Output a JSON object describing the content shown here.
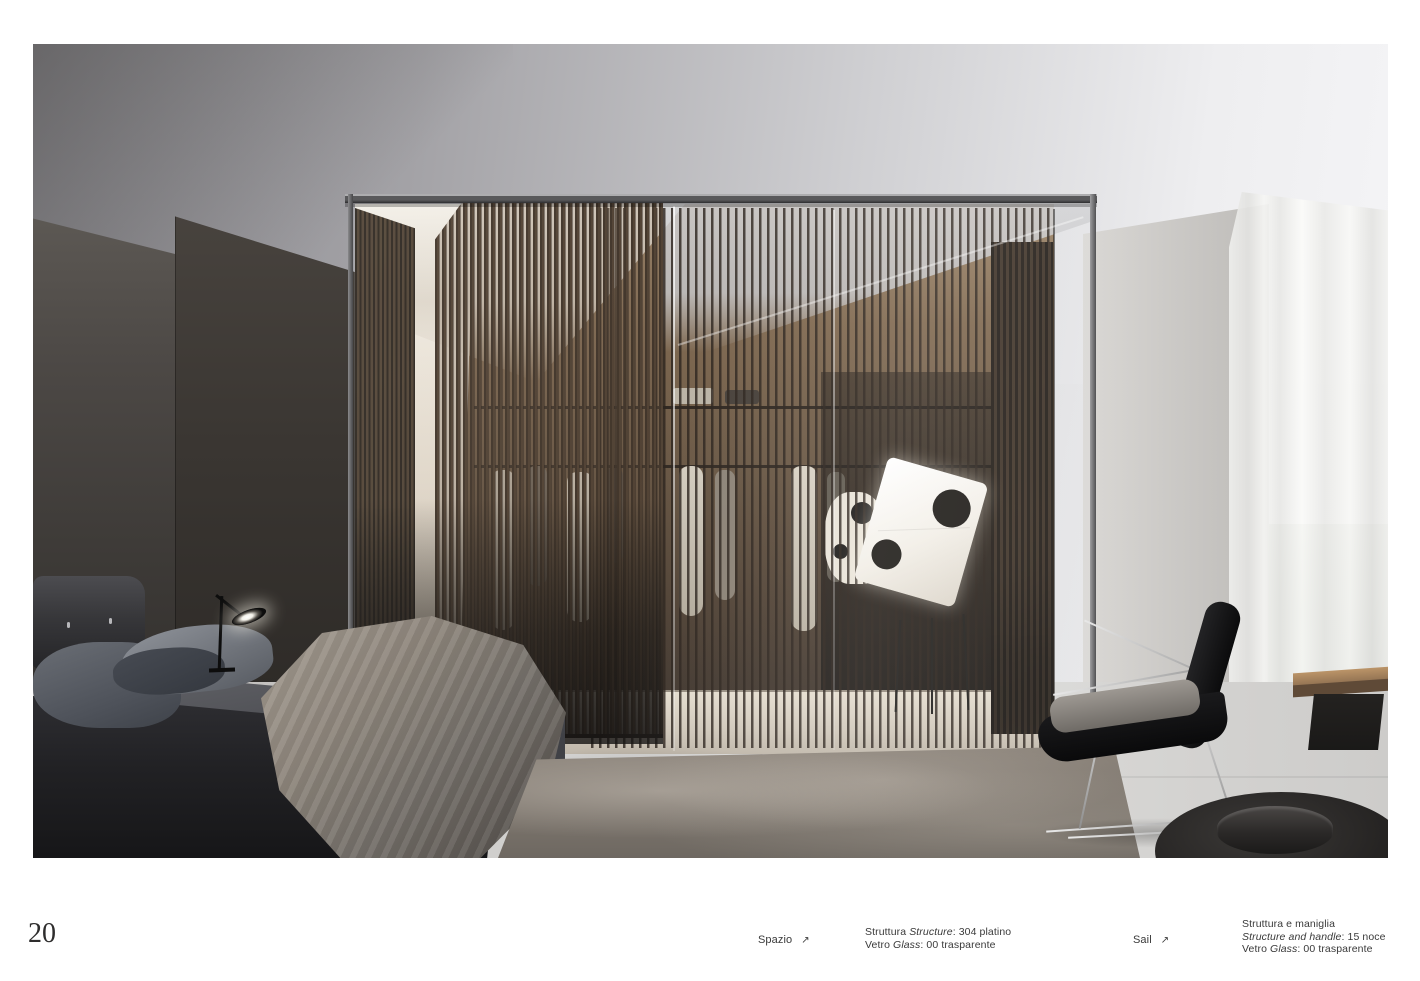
{
  "page": {
    "number": "20",
    "background": "#ffffff"
  },
  "colors": {
    "caption_text": "#3a3a3a",
    "page_number": "#2e2d2d",
    "wood_slats": "#4a3a2b",
    "warm_interior": "#6b563f",
    "concrete_wall": "#c9c7c4"
  },
  "captions": {
    "left_product": {
      "name": "Spazio",
      "arrow": "↗"
    },
    "left_specs": {
      "line1_roman1": "Struttura ",
      "line1_italic": "Structure",
      "line1_roman2": ": 304 platino",
      "line2_roman1": "Vetro ",
      "line2_italic": "Glass",
      "line2_roman2": ": 00 trasparente"
    },
    "right_product": {
      "name": "Sail",
      "arrow": "↗"
    },
    "right_specs": {
      "line1": "Struttura e maniglia",
      "line2_italic": "Structure and handle",
      "line2_roman": ": 15 noce",
      "line3_roman1": "Vetro ",
      "line3_italic": "Glass",
      "line3_roman2": ": 00 trasparente"
    }
  }
}
